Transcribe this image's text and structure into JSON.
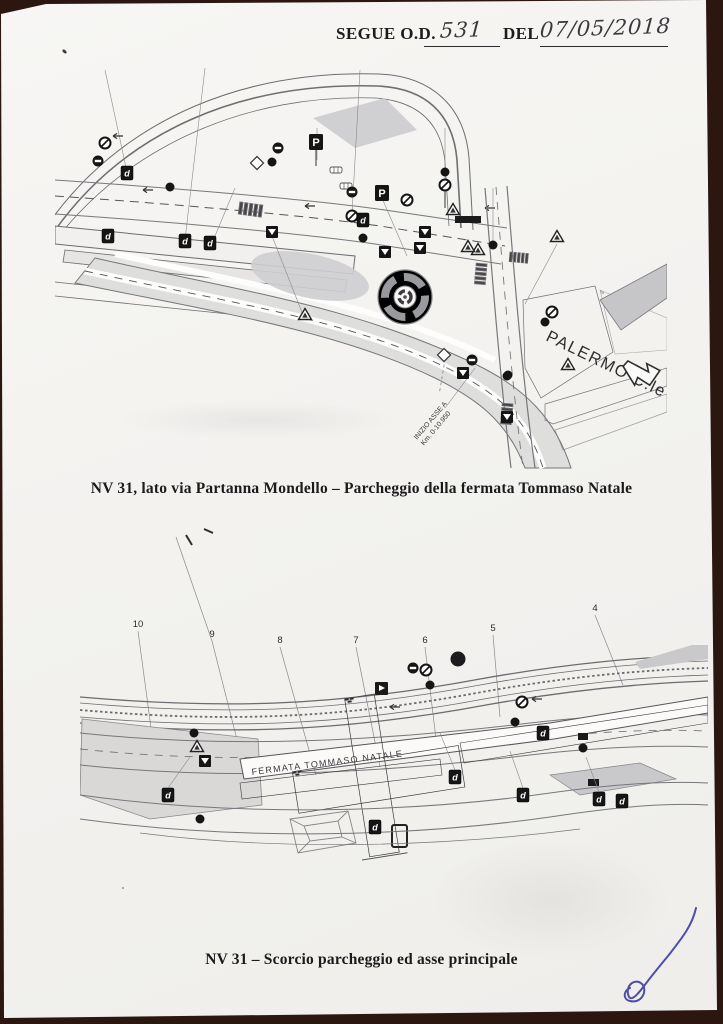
{
  "header": {
    "segue_label": "SEGUE O.D.",
    "od_number": "531",
    "del_label": "DEL",
    "date": "07/05/2018"
  },
  "captions": {
    "first": "NV 31, lato via Partanna Mondello – Parcheggio della fermata Tommaso Natale",
    "second": "NV 31 – Scorcio parcheggio ed asse principale"
  },
  "drawing1": {
    "palermo_label": "PALERMO C.le",
    "asse_label": "INIZIO ASSE A",
    "km_label": "Km. 0-10.950",
    "sign_letters": {
      "d": "d",
      "p": "P"
    }
  },
  "drawing2": {
    "fermata_label": "FERMATA TOMMASO NATALE",
    "callouts": [
      "10",
      "9",
      "8",
      "7",
      "6",
      "5",
      "4"
    ]
  },
  "colors": {
    "signature_ink": "#3c3c9e",
    "scan_border": "#2c1710",
    "paper": "#f5f4f2",
    "sign_black": "#151515"
  }
}
